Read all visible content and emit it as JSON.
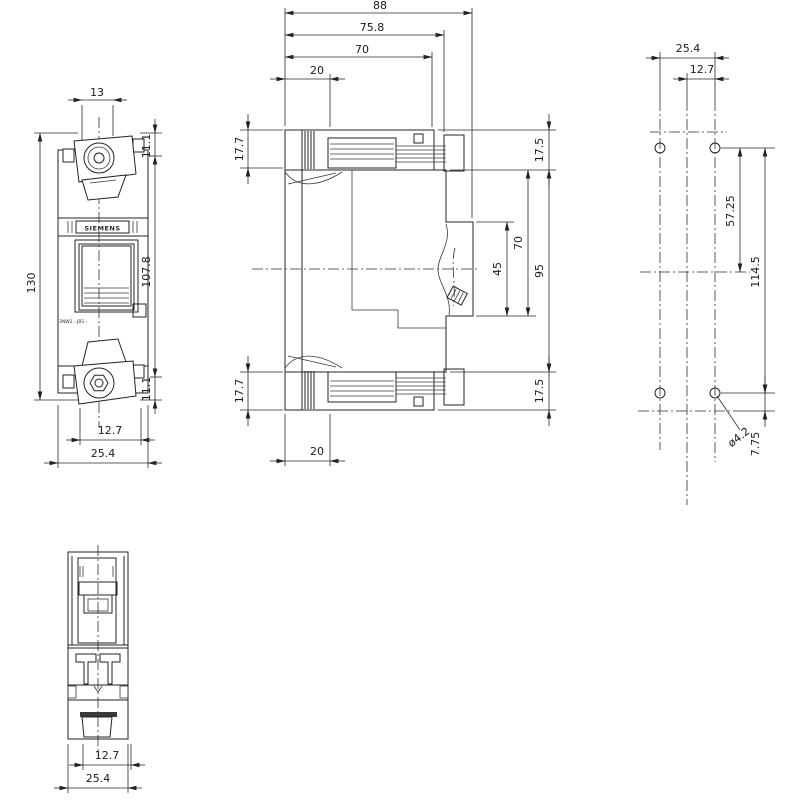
{
  "product": {
    "brand_label": "SIEMENS",
    "part_number": "3NW1.-.JB1.-"
  },
  "views": {
    "front": {
      "width_top": "13",
      "terminal_top": "11.1",
      "overall_height": "130",
      "body_height": "107.8",
      "terminal_bottom": "11.1",
      "inner_width": "12.7",
      "overall_width": "25.4"
    },
    "side": {
      "overall_depth": "88",
      "housing_depth": "75.8",
      "front_depth": "70",
      "terminal_depth_top": "20",
      "terminal_height_top": "17.7",
      "terminal_height_bottom": "17.7",
      "top_offset": "17.5",
      "window_height": "45",
      "front_height": "70",
      "mounting_height": "95",
      "bottom_offset": "17.5",
      "terminal_depth_bottom": "20"
    },
    "mounting": {
      "hole_pitch_h": "25.4",
      "hole_offset_h": "12.7",
      "upper_hole_to_center": "57.25",
      "hole_pitch_v": "114.5",
      "hole_diameter": "ø4.2",
      "lower_hole_offset": "7.75"
    },
    "bottom": {
      "inner_width": "12.7",
      "overall_width": "25.4"
    }
  }
}
